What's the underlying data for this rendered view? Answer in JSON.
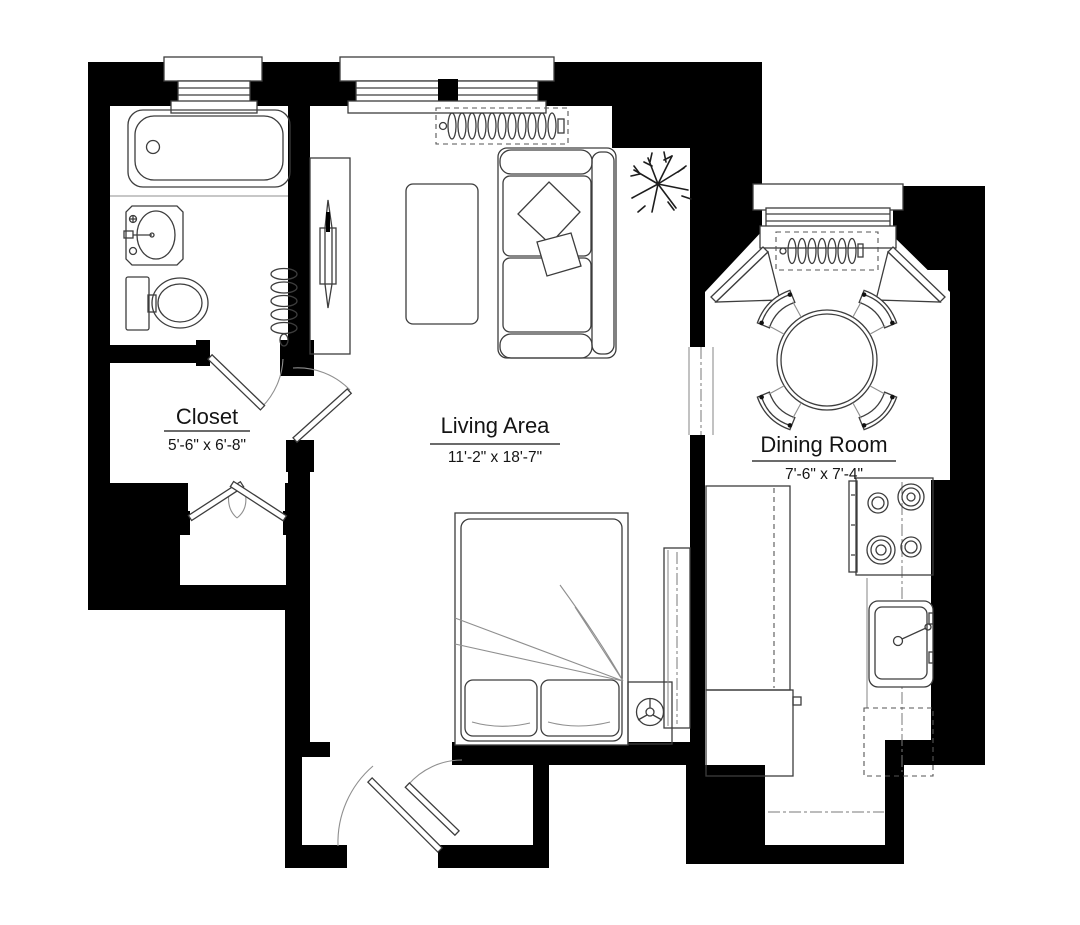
{
  "plan": {
    "title": "Apartment floor plan",
    "colors": {
      "walls": "#000000",
      "fixture_lines": "#3d3d3d",
      "background": "#ffffff"
    },
    "rooms": {
      "closet": {
        "label": "Closet",
        "dimensions": "5'-6\" x 6'-8\""
      },
      "living_area": {
        "label": "Living Area",
        "dimensions": "11'-2\" x 18'-7\""
      },
      "dining_room": {
        "label": "Dining Room",
        "dimensions": "7'-6\" x 7'-4\""
      }
    },
    "unlabeled_rooms": [
      "bathroom",
      "kitchen",
      "entry-vestibule",
      "storage-alcove"
    ],
    "fixtures": {
      "bathroom": [
        "bathtub",
        "sink",
        "toilet",
        "radiator",
        "window"
      ],
      "living_area": [
        "double-window",
        "radiator",
        "sofa",
        "throw-pillows",
        "coffee-table",
        "tv-console",
        "plant",
        "double-bed",
        "bed-pillows",
        "nightstand",
        "fan",
        "dresser"
      ],
      "dining_room": [
        "bay-window",
        "radiator",
        "round-table",
        "four-chairs",
        "corner-shelves"
      ],
      "kitchen": [
        "counter",
        "under-counter-appliance",
        "stove-four-burner",
        "kitchen-sink",
        "refrigerator-dashed"
      ],
      "doors": [
        "bathroom-door",
        "closet-door",
        "bifold-closet-doors",
        "entry-doors"
      ]
    }
  }
}
